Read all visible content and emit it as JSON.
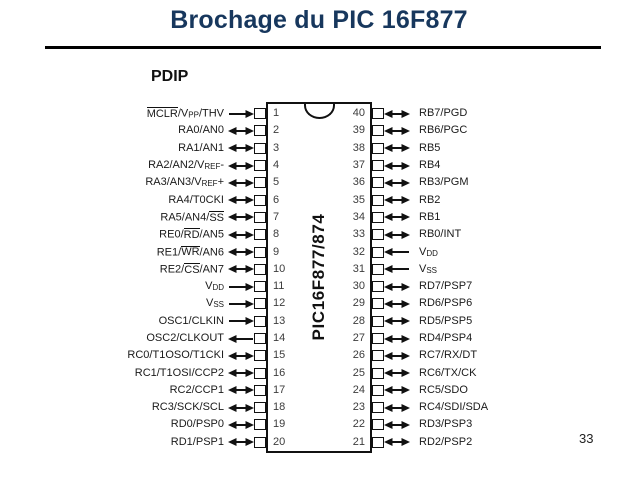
{
  "slide": {
    "title": "Brochage du PIC 16F877",
    "page_number": "33"
  },
  "colors": {
    "title": "#17375d",
    "ink": "#141414"
  },
  "diagram": {
    "package_label": "PDIP",
    "chip_label": "PIC16F877/874",
    "left_pins": [
      {
        "number": "1",
        "label": "[[MCLR]]/V~PP~/THV",
        "dir": "in"
      },
      {
        "number": "2",
        "label": "RA0/AN0",
        "dir": "bi"
      },
      {
        "number": "3",
        "label": "RA1/AN1",
        "dir": "bi"
      },
      {
        "number": "4",
        "label": "RA2/AN2/V~REF~-",
        "dir": "bi"
      },
      {
        "number": "5",
        "label": "RA3/AN3/V~REF~+",
        "dir": "bi"
      },
      {
        "number": "6",
        "label": "RA4/T0CKI",
        "dir": "bi"
      },
      {
        "number": "7",
        "label": "RA5/AN4/[[SS]]",
        "dir": "bi"
      },
      {
        "number": "8",
        "label": "RE0/[[RD]]/AN5",
        "dir": "bi"
      },
      {
        "number": "9",
        "label": "RE1/[[WR]]/AN6",
        "dir": "bi"
      },
      {
        "number": "10",
        "label": "RE2/[[CS]]/AN7",
        "dir": "bi"
      },
      {
        "number": "11",
        "label": "V~DD~",
        "dir": "in"
      },
      {
        "number": "12",
        "label": "V~SS~",
        "dir": "in"
      },
      {
        "number": "13",
        "label": "OSC1/CLKIN",
        "dir": "in"
      },
      {
        "number": "14",
        "label": "OSC2/CLKOUT",
        "dir": "out"
      },
      {
        "number": "15",
        "label": "RC0/T1OSO/T1CKI",
        "dir": "bi"
      },
      {
        "number": "16",
        "label": "RC1/T1OSI/CCP2",
        "dir": "bi"
      },
      {
        "number": "17",
        "label": "RC2/CCP1",
        "dir": "bi"
      },
      {
        "number": "18",
        "label": "RC3/SCK/SCL",
        "dir": "bi"
      },
      {
        "number": "19",
        "label": "RD0/PSP0",
        "dir": "bi"
      },
      {
        "number": "20",
        "label": "RD1/PSP1",
        "dir": "bi"
      }
    ],
    "right_pins": [
      {
        "number": "40",
        "label": "RB7/PGD",
        "dir": "bi"
      },
      {
        "number": "39",
        "label": "RB6/PGC",
        "dir": "bi"
      },
      {
        "number": "38",
        "label": "RB5",
        "dir": "bi"
      },
      {
        "number": "37",
        "label": "RB4",
        "dir": "bi"
      },
      {
        "number": "36",
        "label": "RB3/PGM",
        "dir": "bi"
      },
      {
        "number": "35",
        "label": "RB2",
        "dir": "bi"
      },
      {
        "number": "34",
        "label": "RB1",
        "dir": "bi"
      },
      {
        "number": "33",
        "label": "RB0/INT",
        "dir": "bi"
      },
      {
        "number": "32",
        "label": "V~DD~",
        "dir": "in"
      },
      {
        "number": "31",
        "label": "V~SS~",
        "dir": "in"
      },
      {
        "number": "30",
        "label": "RD7/PSP7",
        "dir": "bi"
      },
      {
        "number": "29",
        "label": "RD6/PSP6",
        "dir": "bi"
      },
      {
        "number": "28",
        "label": "RD5/PSP5",
        "dir": "bi"
      },
      {
        "number": "27",
        "label": "RD4/PSP4",
        "dir": "bi"
      },
      {
        "number": "26",
        "label": "RC7/RX/DT",
        "dir": "bi"
      },
      {
        "number": "25",
        "label": "RC6/TX/CK",
        "dir": "bi"
      },
      {
        "number": "24",
        "label": "RC5/SDO",
        "dir": "bi"
      },
      {
        "number": "23",
        "label": "RC4/SDI/SDA",
        "dir": "bi"
      },
      {
        "number": "22",
        "label": "RD3/PSP3",
        "dir": "bi"
      },
      {
        "number": "21",
        "label": "RD2/PSP2",
        "dir": "bi"
      }
    ]
  }
}
